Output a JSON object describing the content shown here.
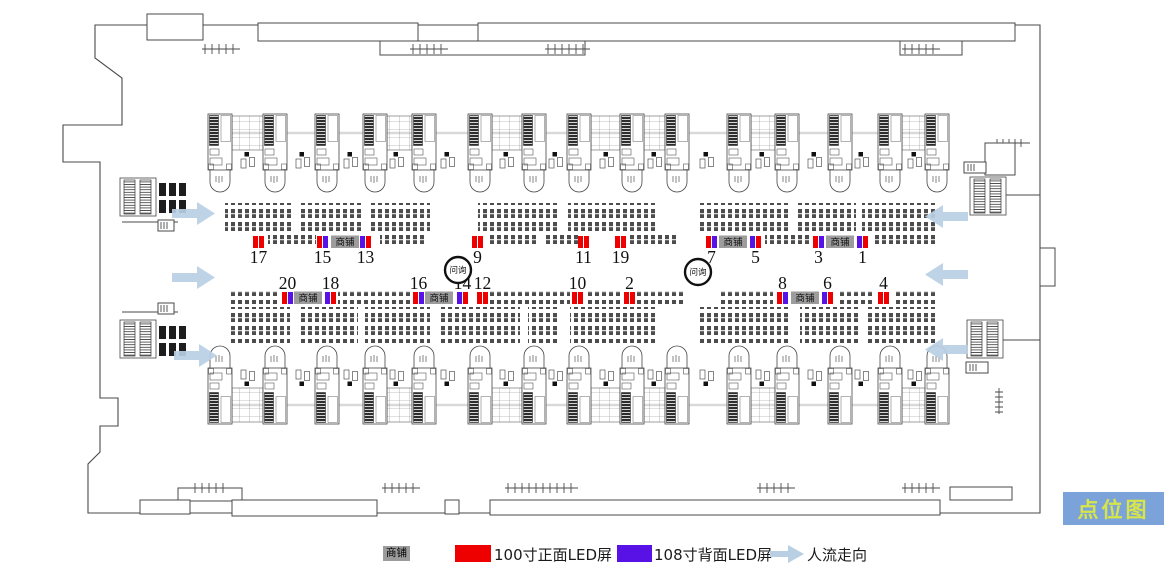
{
  "title": {
    "label": "点位图",
    "bg_color": "#7ba3d9",
    "text_color": "#d7e549"
  },
  "colors": {
    "front_led": "#ee0000",
    "back_led": "#5812e6",
    "shop_bg": "#9c9c9c",
    "flow_arrow": "#b9cfe3"
  },
  "legend": {
    "shop_label": "商铺",
    "items": [
      {
        "name": "front-led",
        "swatch_color": "#ee0000",
        "label": "100寸正面LED屏"
      },
      {
        "name": "back-led",
        "swatch_color": "#5812e6",
        "label": "108寸背面LED屏"
      },
      {
        "name": "people-flow",
        "label": "人流走向"
      }
    ]
  },
  "map": {
    "info_circle_label": "问询",
    "shop_box_label": "商铺",
    "info_circles": [
      {
        "x": 458,
        "y": 270
      },
      {
        "x": 698,
        "y": 272
      }
    ],
    "shop_boxes": [
      {
        "x": 331,
        "row": "top"
      },
      {
        "x": 719,
        "row": "top"
      },
      {
        "x": 826,
        "row": "top"
      },
      {
        "x": 294,
        "row": "bottom"
      },
      {
        "x": 425,
        "row": "bottom"
      },
      {
        "x": 791,
        "row": "bottom"
      }
    ],
    "positions": [
      {
        "num": "17",
        "row": "top",
        "x": 253,
        "bars": [
          "red",
          "red"
        ]
      },
      {
        "num": "15",
        "row": "top",
        "x": 317,
        "bars": [
          "red",
          "purple"
        ]
      },
      {
        "num": "13",
        "row": "top",
        "x": 360,
        "bars": [
          "purple",
          "red"
        ]
      },
      {
        "num": "9",
        "row": "top",
        "x": 472,
        "bars": [
          "red",
          "red"
        ]
      },
      {
        "num": "11",
        "row": "top",
        "x": 578,
        "bars": [
          "red",
          "red"
        ]
      },
      {
        "num": "19",
        "row": "top",
        "x": 615,
        "bars": [
          "red",
          "red"
        ]
      },
      {
        "num": "7",
        "row": "top",
        "x": 706,
        "bars": [
          "red",
          "purple"
        ]
      },
      {
        "num": "5",
        "row": "top",
        "x": 750,
        "bars": [
          "purple",
          "red"
        ]
      },
      {
        "num": "3",
        "row": "top",
        "x": 813,
        "bars": [
          "red",
          "purple"
        ]
      },
      {
        "num": "1",
        "row": "top",
        "x": 857,
        "bars": [
          "purple",
          "red"
        ]
      },
      {
        "num": "20",
        "row": "bottom",
        "x": 282,
        "bars": [
          "red",
          "purple"
        ]
      },
      {
        "num": "18",
        "row": "bottom",
        "x": 325,
        "bars": [
          "purple",
          "red"
        ]
      },
      {
        "num": "16",
        "row": "bottom",
        "x": 413,
        "bars": [
          "red",
          "purple"
        ]
      },
      {
        "num": "14",
        "row": "bottom",
        "x": 457,
        "bars": [
          "purple",
          "red"
        ]
      },
      {
        "num": "12",
        "row": "bottom",
        "x": 477,
        "bars": [
          "red",
          "red"
        ]
      },
      {
        "num": "10",
        "row": "bottom",
        "x": 572,
        "bars": [
          "red",
          "red"
        ]
      },
      {
        "num": "2",
        "row": "bottom",
        "x": 624,
        "bars": [
          "red",
          "red"
        ]
      },
      {
        "num": "8",
        "row": "bottom",
        "x": 777,
        "bars": [
          "red",
          "purple"
        ]
      },
      {
        "num": "6",
        "row": "bottom",
        "x": 822,
        "bars": [
          "purple",
          "red"
        ]
      },
      {
        "num": "4",
        "row": "bottom",
        "x": 878,
        "bars": [
          "red",
          "red"
        ]
      }
    ],
    "flow_arrows": [
      {
        "x": 172,
        "y": 202,
        "dir": "right"
      },
      {
        "x": 172,
        "y": 266,
        "dir": "right"
      },
      {
        "x": 174,
        "y": 344,
        "dir": "right"
      },
      {
        "x": 968,
        "y": 205,
        "dir": "left"
      },
      {
        "x": 968,
        "y": 263,
        "dir": "left"
      },
      {
        "x": 968,
        "y": 338,
        "dir": "left"
      }
    ]
  }
}
